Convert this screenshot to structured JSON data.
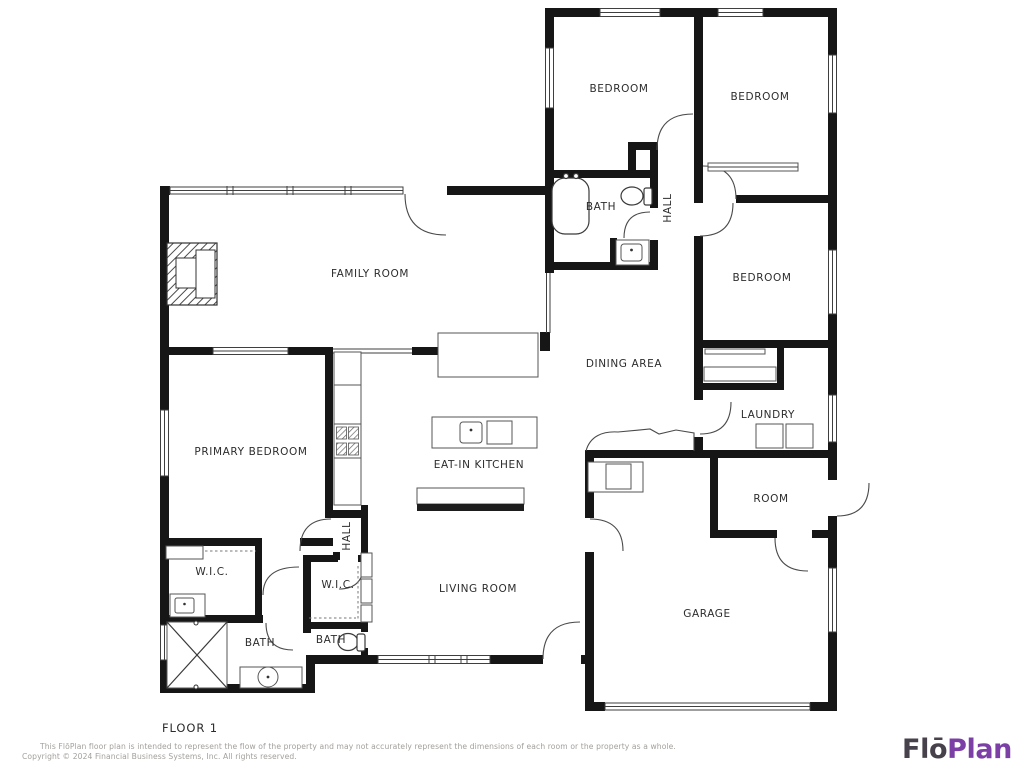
{
  "floor_label": "FLOOR 1",
  "rooms": {
    "bedroom_a": "BEDROOM",
    "bedroom_b": "BEDROOM",
    "bedroom_c": "BEDROOM",
    "bath_upper": "BATH",
    "hall_upper": "HALL",
    "family_room": "FAMILY ROOM",
    "dining_area": "DINING AREA",
    "primary_bedroom": "PRIMARY BEDROOM",
    "eat_in_kitchen": "EAT-IN KITCHEN",
    "laundry": "LAUNDRY",
    "room": "ROOM",
    "wic_left": "W.I.C.",
    "wic_right": "W.I.C.",
    "hall_lower": "HALL",
    "bath_left": "BATH",
    "bath_right": "BATH",
    "living_room": "LIVING ROOM",
    "garage": "GARAGE"
  },
  "footer": {
    "disclaimer_line1": "This FlōPlan floor plan is intended to represent the flow of the property and may not accurately represent the dimensions of each room or the property as a whole.",
    "disclaimer_line2": "Copyright © 2024 Financial Business Systems, Inc. All rights reserved."
  },
  "logo": {
    "part1": "Flō",
    "part2": "Plan"
  },
  "colors": {
    "wall": "#161616",
    "label": "#2d2d2d",
    "disclaimer_gray": "#a3a09c",
    "logo_dark": "#47414b",
    "logo_purple": "#7b3fa6",
    "background": "#ffffff"
  }
}
